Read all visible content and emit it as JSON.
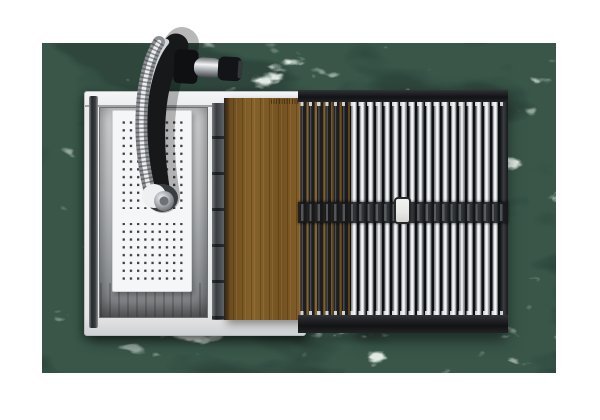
{
  "meta": {
    "title": "Top-down product photo of a stainless workstation kitchen sink set into a green marble countertop",
    "canvas": {
      "width": 600,
      "height": 420
    }
  },
  "scene": {
    "background": {
      "label": "white studio backdrop"
    },
    "countertop": {
      "label": "polished green marble countertop with white veining"
    },
    "sink": {
      "label": "stainless steel workstation sink with white rim and inner ledge track",
      "bowl": "brushed stainless sink bowl",
      "track": "notched ledge track for sliding accessories"
    },
    "faucet": {
      "label": "matte black pull-down kitchen faucet seen from above",
      "hose": "coiled braided chrome pull-down hose reaching into the bowl",
      "handle": "side-mounted chrome lever handle with black tip",
      "spray_head": "chrome spray head with white collar resting on the colander"
    },
    "colander": {
      "label": "white perforated colander basket with grid of square drain holes, two hole fields separated by a plain band"
    },
    "cutting_board": {
      "label": "sliding walnut cutting board with vertical grain",
      "stamp": "tiny engraved brand stamp near top edge (illegible)"
    },
    "drying_rack": {
      "label": "roll-up drying rack of stainless rods with black silicone ends",
      "left_section": "dark rods passing over the cutting board",
      "center_strap": "black cross strap joining the rods at mid-length",
      "tag": "white rounded tab at center of strap"
    }
  },
  "colors": {
    "marble_base": "#2e463c",
    "marble_vein": "#d4e4d8",
    "marble_shadow": "#17261f",
    "steel_rim": "#edeff0",
    "steel_wall_dark": "#85888b",
    "colander_white": "#f5f6f7",
    "hole_dark": "#3b3e42",
    "wood_mid": "#7a5621",
    "wood_edge": "#2e2215",
    "rack_black": "#1d1f22",
    "rod_silver": "#f2f3f4",
    "faucet_black": "#17181a",
    "chrome_light": "#d7dadd",
    "tag_white": "#e8e9e6",
    "background_white": "#ffffff"
  }
}
